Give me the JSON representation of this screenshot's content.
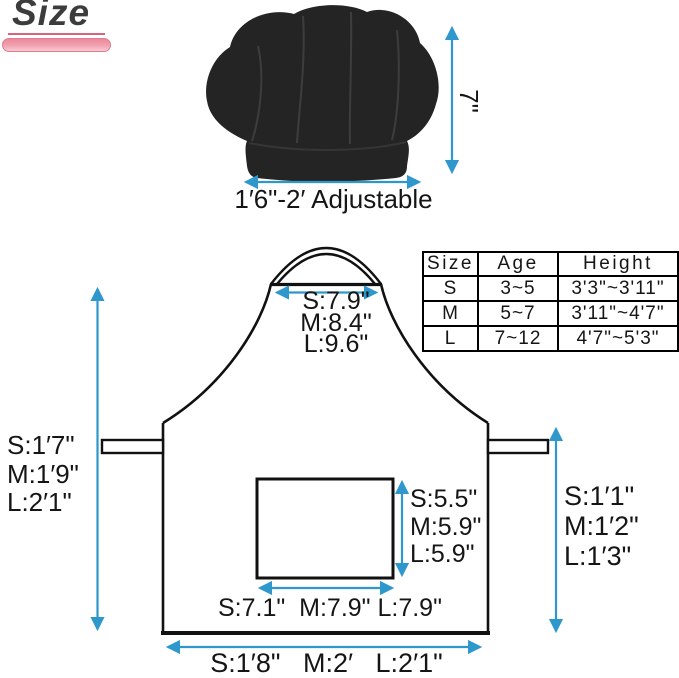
{
  "page": {
    "title": "Size"
  },
  "hat": {
    "height_label": "7\"",
    "width_label": "1′6\"-2′ Adjustable"
  },
  "apron_measurements": {
    "neck_width": {
      "s": "S:7.9\"",
      "m": "M:8.4\"",
      "l": "L:9.6\""
    },
    "total_length": {
      "s": "S:1′7\"",
      "m": "M:1′9\"",
      "l": "L:2′1\""
    },
    "skirt_length": {
      "s": "S:1′1\"",
      "m": "M:1′2\"",
      "l": "L:1′3\""
    },
    "pocket_height": {
      "s": "S:5.5\"",
      "m": "M:5.9\"",
      "l": "L:5.9\""
    },
    "pocket_width_label": "S:7.1\"  M:7.9\" L:7.9\"",
    "bottom_width_label": "S:1′8\"   M:2′   L:2′1\""
  },
  "size_table": {
    "headers": [
      "Size",
      "Age",
      "Height"
    ],
    "rows": [
      [
        "S",
        "3~5",
        "3'3\"~3'11\""
      ],
      [
        "M",
        "5~7",
        "3'11\"~4'7\""
      ],
      [
        "L",
        "7~12",
        "4'7\"~5'3\""
      ]
    ]
  },
  "colors": {
    "arrow_blue": "#2e97cc",
    "accent_pink": "#ef9cac",
    "underline_pink": "#d8637a",
    "hat_black": "#242424",
    "line_black": "#111111"
  }
}
